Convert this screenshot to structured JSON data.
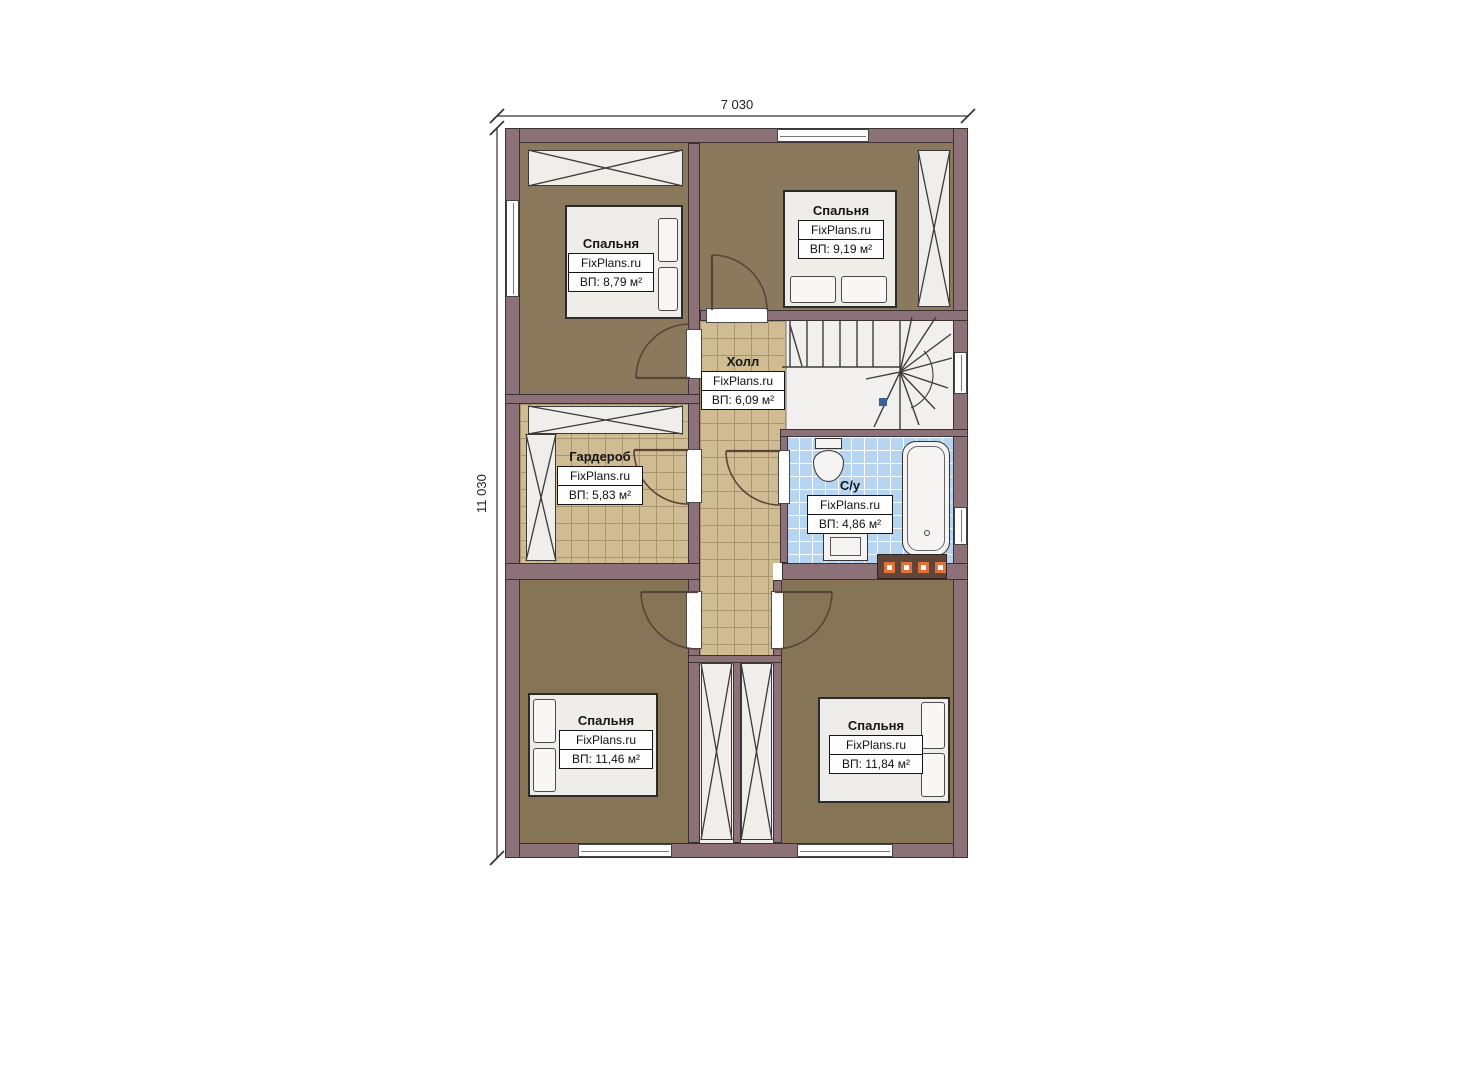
{
  "dimensions": {
    "width": "7 030",
    "height": "11 030"
  },
  "watermark": "FixPlans.ru",
  "rooms": [
    {
      "id": "bedroom-top-left",
      "name": "Спальня",
      "area": "ВП: 8,79 м²"
    },
    {
      "id": "bedroom-top-right",
      "name": "Спальня",
      "area": "ВП: 9,19 м²"
    },
    {
      "id": "hall",
      "name": "Холл",
      "area": "ВП: 6,09 м²"
    },
    {
      "id": "wardrobe",
      "name": "Гардероб",
      "area": "ВП: 5,83 м²"
    },
    {
      "id": "bathroom",
      "name": "С/у",
      "area": "ВП: 4,86 м²"
    },
    {
      "id": "bedroom-bottom-left",
      "name": "Спальня",
      "area": "ВП: 11,46 м²"
    },
    {
      "id": "bedroom-bottom-right",
      "name": "Спальня",
      "area": "ВП: 11,84 м²"
    }
  ],
  "colors": {
    "wall": "#8c7278",
    "bedroom_floor": "#8a795c",
    "tile_floor": "#cfbc92",
    "bathroom_floor": "#b7d4f0",
    "accent_orange": "#e2703a",
    "stair_marker_blue": "#3d5f93"
  }
}
